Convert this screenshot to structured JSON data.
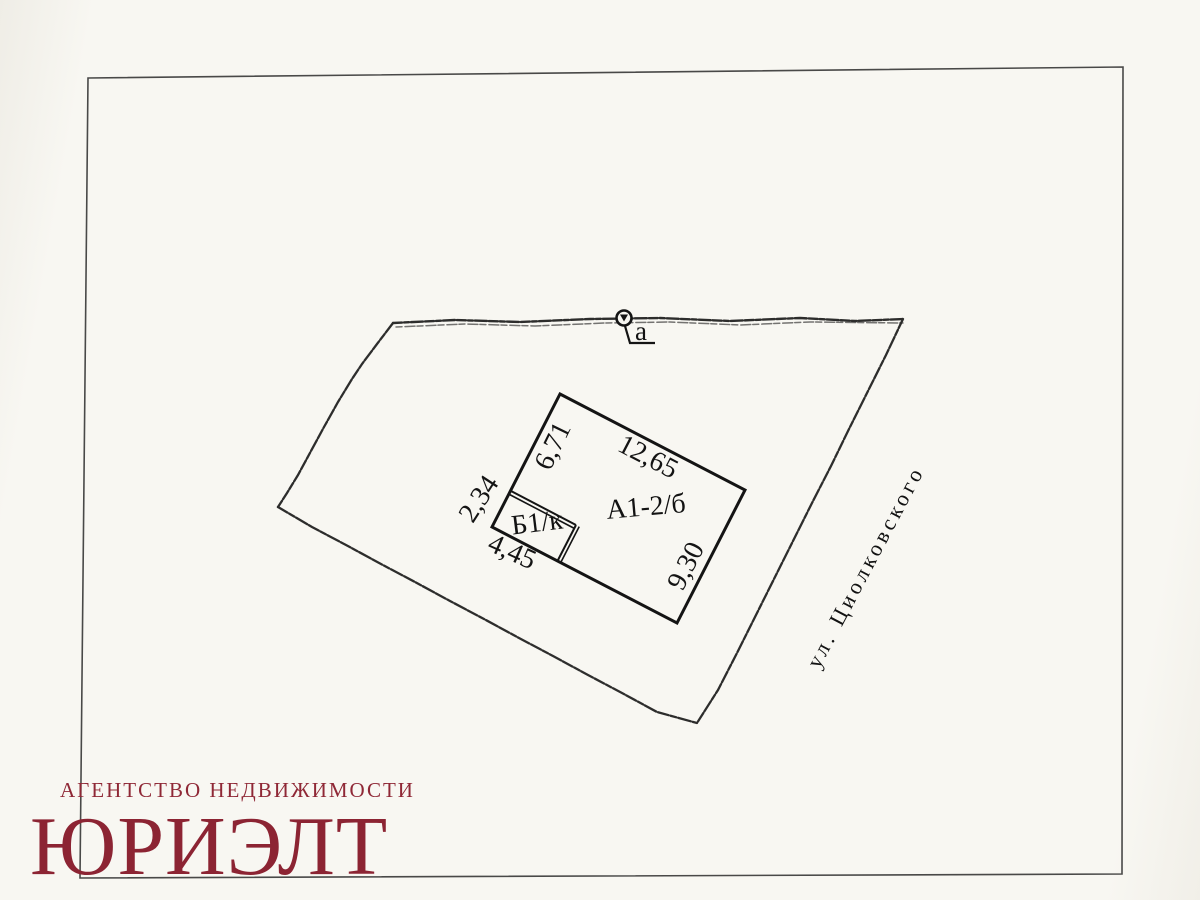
{
  "colors": {
    "ink": "#1c1c1c",
    "paper": "#f7f6f1",
    "watermark_red": "#8c2433"
  },
  "plan": {
    "marker_label": "а",
    "street_label": "ул. Циолковского",
    "main_building_label": "А1-2/б",
    "annex_label": "Б1/к",
    "dimensions": {
      "nw_edge": "6,71",
      "ne_edge": "12,65",
      "se_edge": "9,30",
      "annex_nw": "2,34",
      "annex_sw": "4,45"
    }
  },
  "watermark": {
    "agency_line": "АГЕНТСТВО НЕДВИЖИМОСТИ",
    "brand": "ЮРИЭЛТ"
  }
}
